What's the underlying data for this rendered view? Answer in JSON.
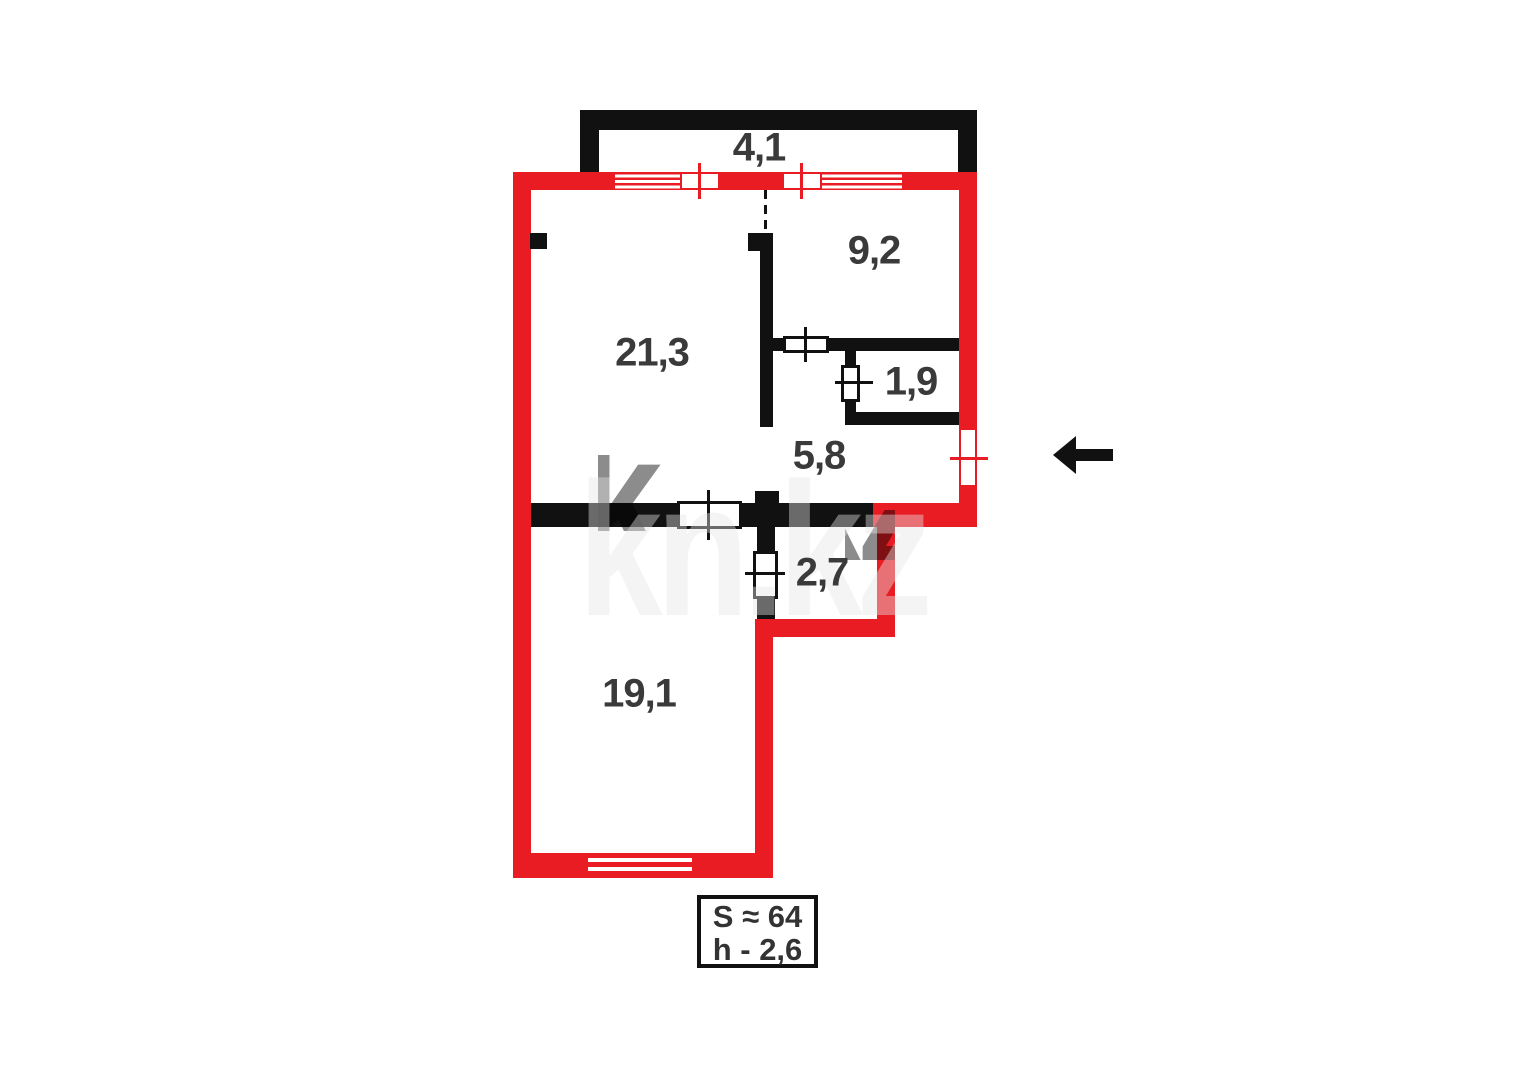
{
  "floorplan": {
    "watermark_text": "kn.kz",
    "info_box": {
      "area_total": "S ≈ 64",
      "ceiling_height": "h - 2,6"
    },
    "rooms": [
      {
        "name": "balcony",
        "area": "4,1"
      },
      {
        "name": "kitchen",
        "area": "9,2"
      },
      {
        "name": "living-room",
        "area": "21,3"
      },
      {
        "name": "bathroom",
        "area": "1,9"
      },
      {
        "name": "hallway",
        "area": "5,8"
      },
      {
        "name": "storage",
        "area": "2,7"
      },
      {
        "name": "bedroom",
        "area": "19,1"
      }
    ],
    "colors": {
      "exterior_wall_red": "#ea1c23",
      "interior_wall_black": "#111111",
      "label_gray": "#3a3a3a"
    }
  }
}
